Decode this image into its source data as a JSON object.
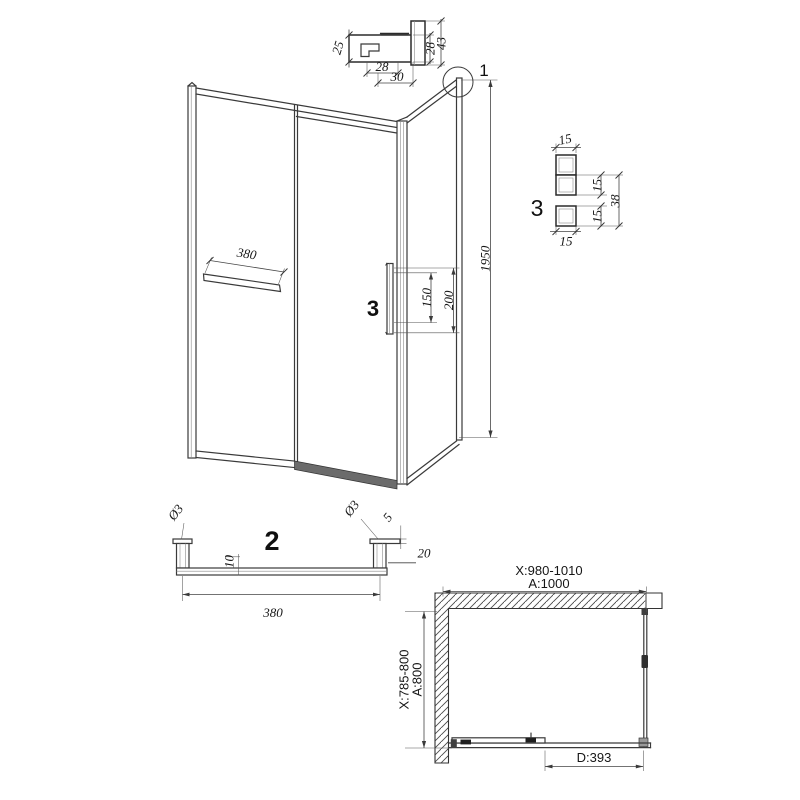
{
  "meta": {
    "background": "#ffffff",
    "line_color": "#3a3a3a"
  },
  "detail1": {
    "callout": "1",
    "dim_left_height": "25",
    "dim_profile_height": "28",
    "dim_overall_height": "43",
    "dim_bottom_width": "28",
    "dim_bottom_overall": "30"
  },
  "elevation": {
    "dim_height": "1950",
    "dim_towel_bar": "380",
    "dim_handle_holes": "150",
    "dim_handle_overall": "200",
    "handle_callout": "3"
  },
  "detail3": {
    "callout": "3",
    "dim_top_width": "15",
    "dim_upper_height": "15",
    "dim_lower_height": "15",
    "dim_overall": "38",
    "dim_bottom_width": "15"
  },
  "figure2": {
    "callout": "2",
    "dia_left_hole": "Ø3",
    "dia_right_hole": "Ø3",
    "dim_cap_thickness": "5",
    "dim_bar_offset": "10",
    "dim_post_width": "20",
    "dim_length": "380"
  },
  "plan": {
    "dim_width_adjust": "X:980-1010",
    "dim_width": "A:1000",
    "dim_depth_adjust": "X:785-800",
    "dim_depth": "A:800",
    "dim_door": "D:393"
  }
}
